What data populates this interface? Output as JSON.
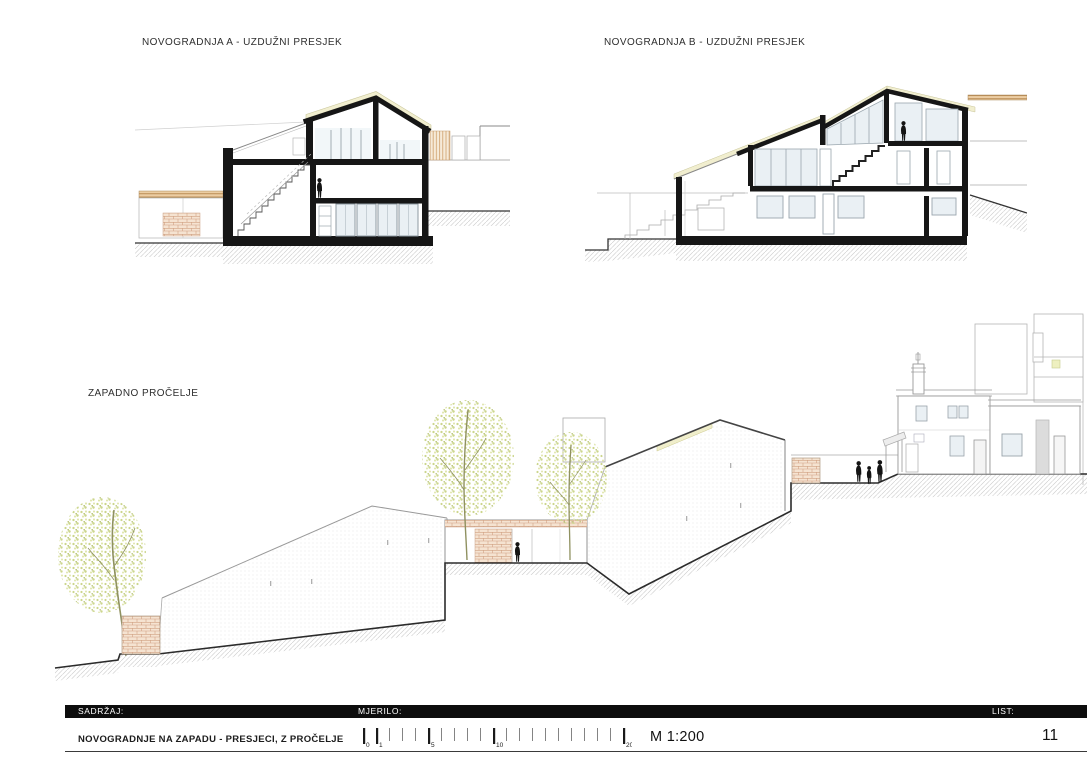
{
  "sheet": {
    "drawings": [
      {
        "id": "section-a",
        "label": "NOVOGRADNJA A - UZDUŽNI PRESJEK"
      },
      {
        "id": "section-b",
        "label": "NOVOGRADNJA B - UZDUŽNI PRESJEK"
      },
      {
        "id": "west-elevation",
        "label": "ZAPADNO PROČELJE"
      }
    ],
    "title_block": {
      "content_label": "SADRŽAJ:",
      "scale_label": "MJERILO:",
      "sheet_label": "LIST:",
      "content_value": "NOVOGRADNJE NA ZAPADU - PRESJECI, Z PROČELJE",
      "scale_value": "M 1:200",
      "sheet_number": "11"
    },
    "scale_bar": {
      "unit_px": 13,
      "max": 20,
      "major": [
        0,
        1,
        5,
        10,
        20
      ],
      "labels": [
        "0",
        "1",
        "5",
        "10",
        "20"
      ]
    },
    "colors": {
      "cut_black": "#161616",
      "roof_cream": "#f1eecf",
      "brick_tan": "#f5e3d1",
      "wood_tan": "#eccda3",
      "glass": "#eaf0f4",
      "foliage": "#ccd68d",
      "terrain_line": "#2b2b2b",
      "hatch": "#c8c8c8"
    }
  }
}
